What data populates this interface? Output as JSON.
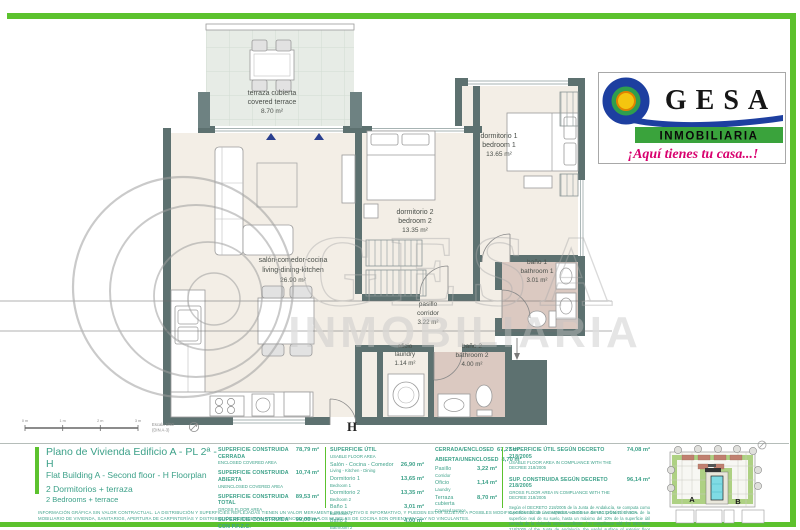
{
  "logo": {
    "name": "GESA",
    "subtitle": "INMOBILIARIA",
    "slogan": "¡Aquí tienes tu casa...!"
  },
  "watermark": {
    "name": "GESA",
    "subtitle": "INMOBILIARIA"
  },
  "plan": {
    "unit_letter": "H",
    "rooms": {
      "terrace": {
        "es": "terraza cubierta",
        "en": "covered terrace",
        "area": "8.70 m²"
      },
      "living": {
        "es": "salón-comedor-cocina",
        "en": "living-dining-kitchen",
        "area": "26.90 m²"
      },
      "bedroom1": {
        "es": "dormitorio 1",
        "en": "bedroom 1",
        "area": "13.65 m²"
      },
      "bedroom2": {
        "es": "dormitorio 2",
        "en": "bedroom 2",
        "area": "13.35 m²"
      },
      "bath1": {
        "es": "baño 1",
        "en": "bathroom 1",
        "area": "3.01 m²"
      },
      "bath2": {
        "es": "baño 2",
        "en": "bathroom 2",
        "area": "4.00 m²"
      },
      "corridor": {
        "es": "pasillo",
        "en": "corridor",
        "area": "3.22 m²"
      },
      "laundry": {
        "es": "oficio",
        "en": "laundry",
        "area": "1.14 m²"
      }
    }
  },
  "scale_bar": {
    "ticks": [
      "0 m",
      "1 m",
      "2 m",
      "3 m"
    ],
    "scale": "Escala 1/50",
    "format": "(DIN A-3)"
  },
  "title_block": {
    "title_es": "Plano de Vivienda Edificio A - PL 2ª - H",
    "title_en": "Flat Building A - Second floor - H  Floorplan",
    "subtitle_es": "2 Dormitorios + terraza",
    "subtitle_en": "2 Bedrooms + terrace"
  },
  "areas_built": {
    "rows": [
      {
        "es": "SUPERFICIE CONSTRUIDA CERRADA",
        "en": "ENCLOSED COVERED AREA",
        "value": "78,79 m²"
      },
      {
        "es": "SUPERFICIE CONSTRUIDA ABIERTA",
        "en": "UNENCLOSED COVERED AREA",
        "value": "10,74 m²"
      },
      {
        "es": "SUPERFICIE CONSTRUIDA TOTAL",
        "en": "GROSS FLOOR AREA",
        "value": "89,53 m²"
      },
      {
        "es": "SUPERFICIE CONSTRUIDA CON P.F.Z.C.",
        "en": "GROSS FLOOR AREA WITH PROPORTIONAL PARTS OF COMMON AREAS",
        "value": "99,00 m²"
      }
    ]
  },
  "areas_usable": {
    "header_es": "SUPERFICIE ÚTIL",
    "header_en": "USABLE FLOOR AREA",
    "rows": [
      {
        "es": "Salón - Cocina - Comedor",
        "en": "Living - Kitchen - Dining",
        "value": "26,90 m²"
      },
      {
        "es": "Dormitorio 1",
        "en": "Bedroom 1",
        "value": "13,65 m²"
      },
      {
        "es": "Dormitorio 2",
        "en": "Bedroom 2",
        "value": "13,35 m²"
      },
      {
        "es": "Baño 1",
        "en": "Bathroom 1",
        "value": "3,01 m²"
      },
      {
        "es": "Baño 2",
        "en": "Bathroom 2",
        "value": "4,00 m²"
      }
    ],
    "rows2": [
      {
        "es": "CERRADA/ENCLOSED",
        "en": "",
        "value": "67,27 m²"
      },
      {
        "es": "ABIERTA/UNENCLOSED",
        "en": "",
        "value": "8,70 m²"
      },
      {
        "es": "Pasillo",
        "en": "Corridor",
        "value": "3,22 m²"
      },
      {
        "es": "Oficio",
        "en": "Laundry",
        "value": "1,14 m²"
      },
      {
        "es": "Terraza cubierta",
        "en": "Covered terrace",
        "value": "8,70 m²"
      }
    ]
  },
  "decree": {
    "rows": [
      {
        "es": "SUPERFICIE ÚTIL SEGÚN DECRETO 218/2005",
        "en": "USABLE FLOOR AREA IN COMPLIANCE WITH THE DECREE 218/2005",
        "value": "74,08 m²"
      },
      {
        "es": "SUP. CONSTRUIDA SEGÚN DECRETO 218/2005",
        "en": "GROSS FLOOR AREA IN COMPLIANCE WITH THE DECREE 218/2005",
        "value": "96,14 m²"
      }
    ],
    "note": "Según el DECRETO 218/2005 de la Junta de Andalucía, se computa como superficie útil de los espacios exteriores de uso privativo el 50% de la superficie real de su suelo, hasta un máximo del 10% de la superficie útil cerrada de la vivienda correspondiente. / In compliance with the DECREE 218/2005 of the Junta de Andalucía, the useful surface of exterior floor spaces which are for the private use of the dwellings means 50% of the actual surface to a maximum of 10% of the useful enclosed surface."
  },
  "site_plan": {
    "building_a": "A",
    "building_b": "B"
  },
  "disclaimer": {
    "line1": "INFORMACIÓN GRÁFICA SIN VALOR CONTRACTUAL. LA DISTRIBUCIÓN Y SUPERFICIES REFLEJADAS TIENEN UN VALOR MERAMENTE ORIENTATIVO E INFORMATIVO, Y PUEDEN ESTAR SUJETAS A POSIBLES MODIFICACIONES DE LA EMPRESA O DE LA DIRECCIÓN TÉCNICA.",
    "line2": "MOBILIARIO DE VIVIENDA, SANITARIOS, APERTURA DE CARPINTERÍAS Y DISTRIBUCIÓN EN GENERAL, NO SON VINCULANTES. LOS MUEBLES DE COCINA SON ORIENTATIVOS Y NO VINCULANTES."
  },
  "colors": {
    "accent_green": "#5cc22e",
    "text_green": "#3da189",
    "wall": "#5d7170",
    "bath_floor": "#dbc9c1",
    "pool": "#7fdbe4"
  }
}
